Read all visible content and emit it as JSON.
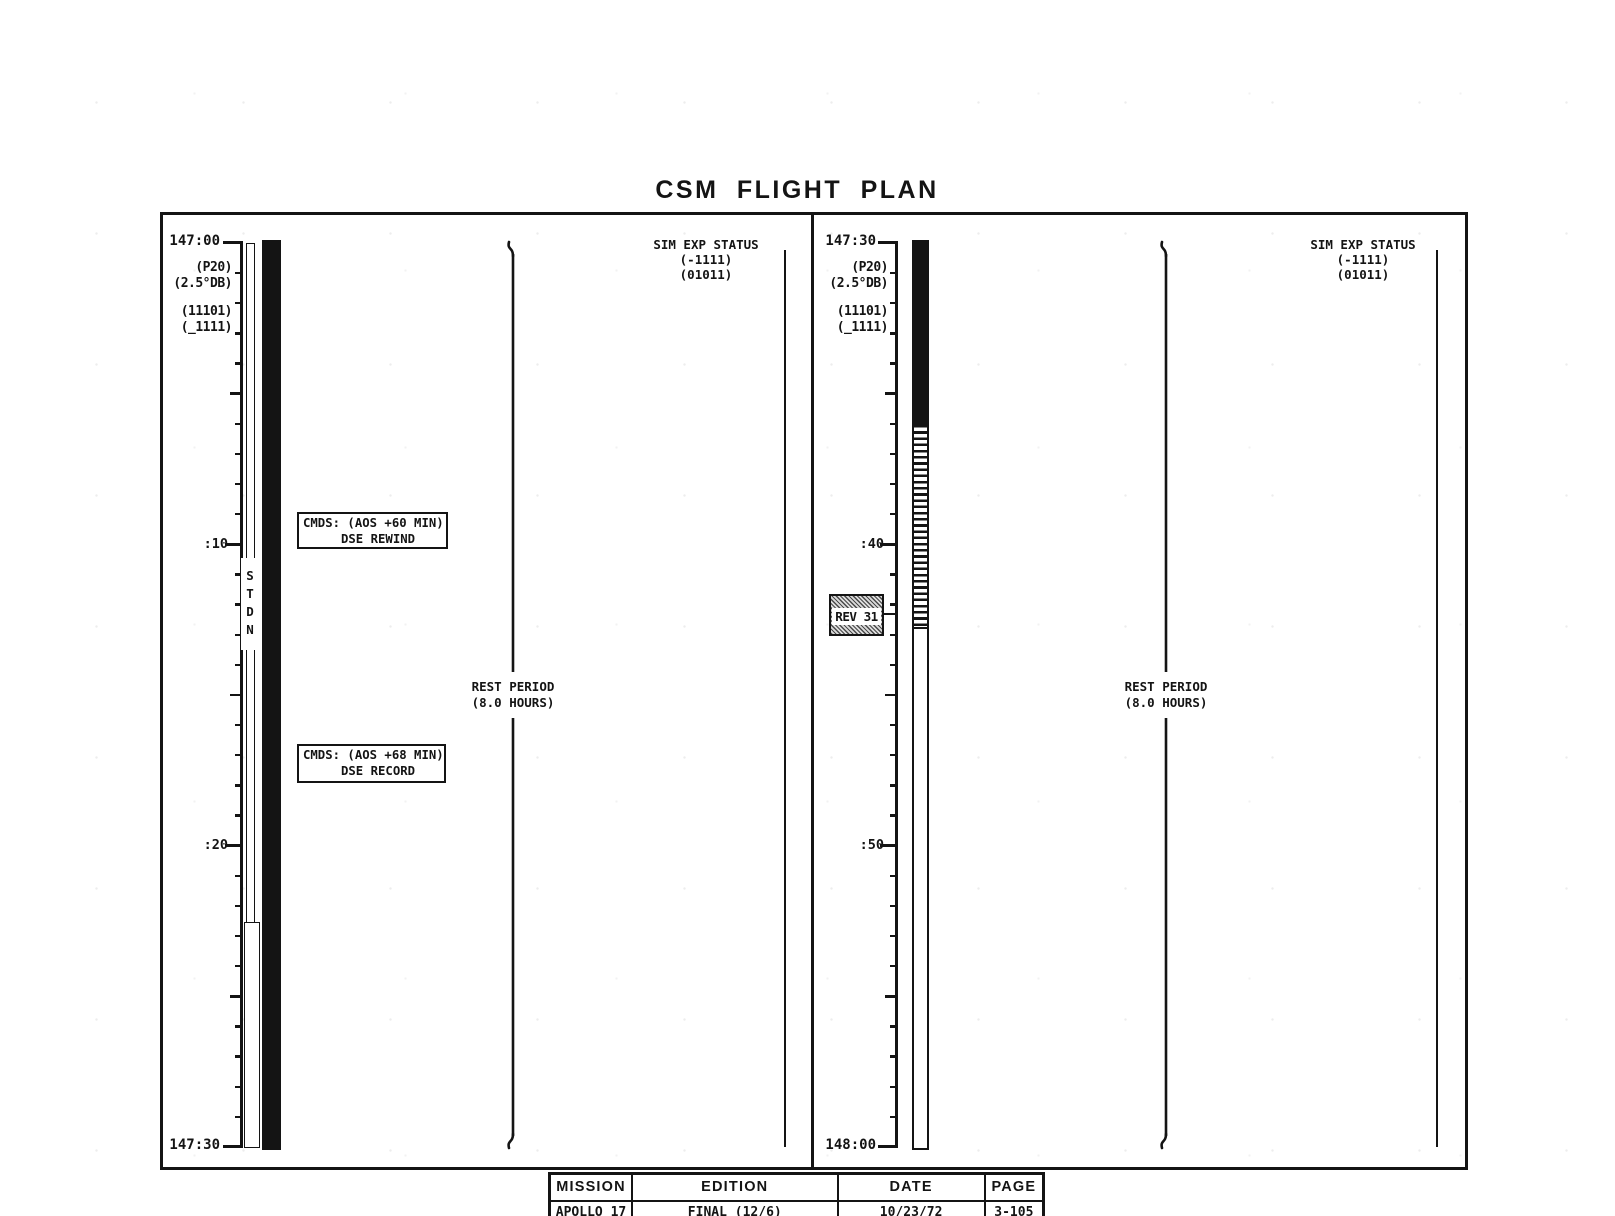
{
  "title": "CSM FLIGHT PLAN",
  "panels": [
    {
      "start_label": "147:00",
      "end_label": "147:30",
      "tick_labels": [
        ":10",
        ":20"
      ],
      "config_labels": [
        "(P20)",
        "(2.5°DB)",
        "(11101)",
        "(_1111)"
      ],
      "station_bar_label": "STDN",
      "cmd_boxes": [
        {
          "line1": "CMDS: (AOS +60 MIN)",
          "line2": "DSE REWIND"
        },
        {
          "line1": "CMDS: (AOS +68 MIN)",
          "line2": "DSE RECORD"
        }
      ],
      "rest_period": {
        "line1": "REST PERIOD",
        "line2": "(8.0 HOURS)"
      },
      "sim_exp_status": {
        "line1": "SIM EXP STATUS",
        "line2": "(-1111)",
        "line3": "(01011)"
      }
    },
    {
      "start_label": "147:30",
      "end_label": "148:00",
      "tick_labels": [
        ":40",
        ":50"
      ],
      "config_labels": [
        "(P20)",
        "(2.5°DB)",
        "(11101)",
        "(_1111)"
      ],
      "rev_label": "REV 31",
      "rest_period": {
        "line1": "REST PERIOD",
        "line2": "(8.0 HOURS)"
      },
      "sim_exp_status": {
        "line1": "SIM EXP STATUS",
        "line2": "(-1111)",
        "line3": "(01011)"
      }
    }
  ],
  "footer": {
    "headers": [
      "MISSION",
      "EDITION",
      "DATE",
      "PAGE"
    ],
    "values": [
      "APOLLO 17",
      "FINAL (12/6)",
      "10/23/72",
      "3-105"
    ]
  }
}
